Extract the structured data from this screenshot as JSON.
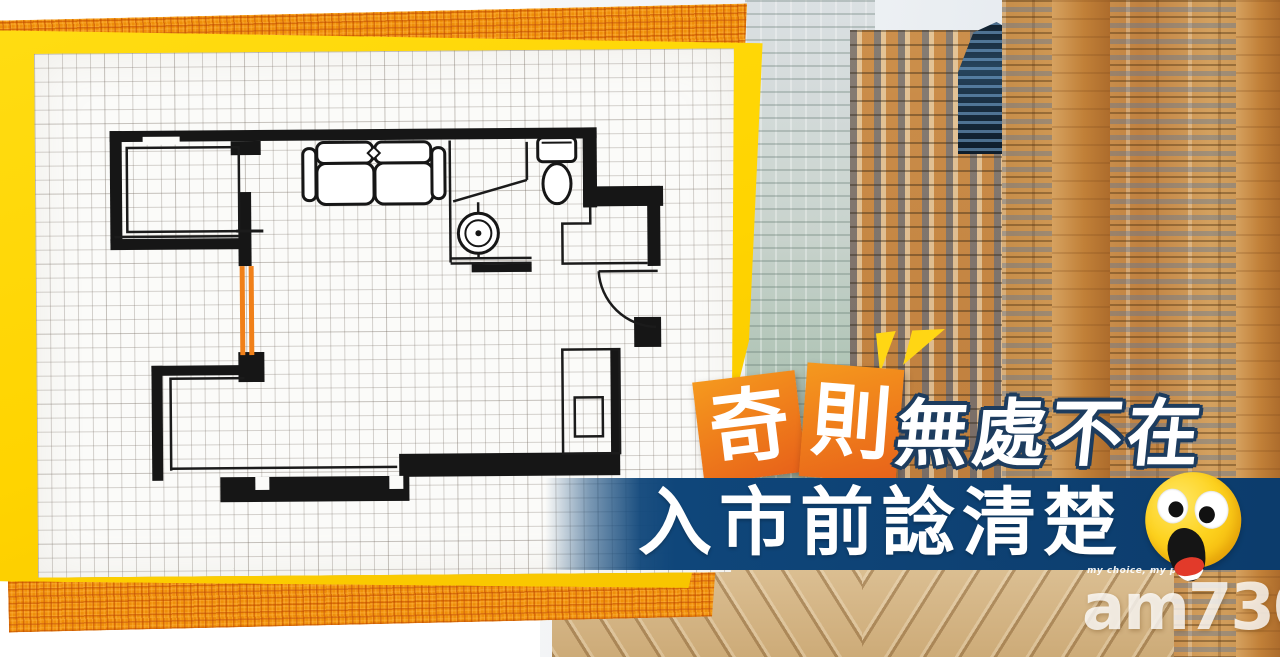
{
  "headline": {
    "badge1": "奇",
    "badge2": "則",
    "line1": "無處不在",
    "line2": "入市前諗清楚"
  },
  "branding": {
    "logo": "am730",
    "tagline": "my choice, my paper"
  },
  "floor_plan": {
    "highlight_color": "#F08019",
    "fixtures": [
      "sofa",
      "toilet",
      "wash-basin",
      "door-swing",
      "wardrobe",
      "highlighted-wall"
    ]
  },
  "colors": {
    "banner_blue": "#0F467A",
    "card_orange_light": "#F5991E",
    "card_orange_dark": "#E7611A",
    "frame_yellow": "#FFD400",
    "plaid_orange": "#EF8F0A",
    "accent_yellow": "#FFD614",
    "headline_outline_navy": "#1D3C5E",
    "emoji_yellow": "#FDD21E"
  }
}
